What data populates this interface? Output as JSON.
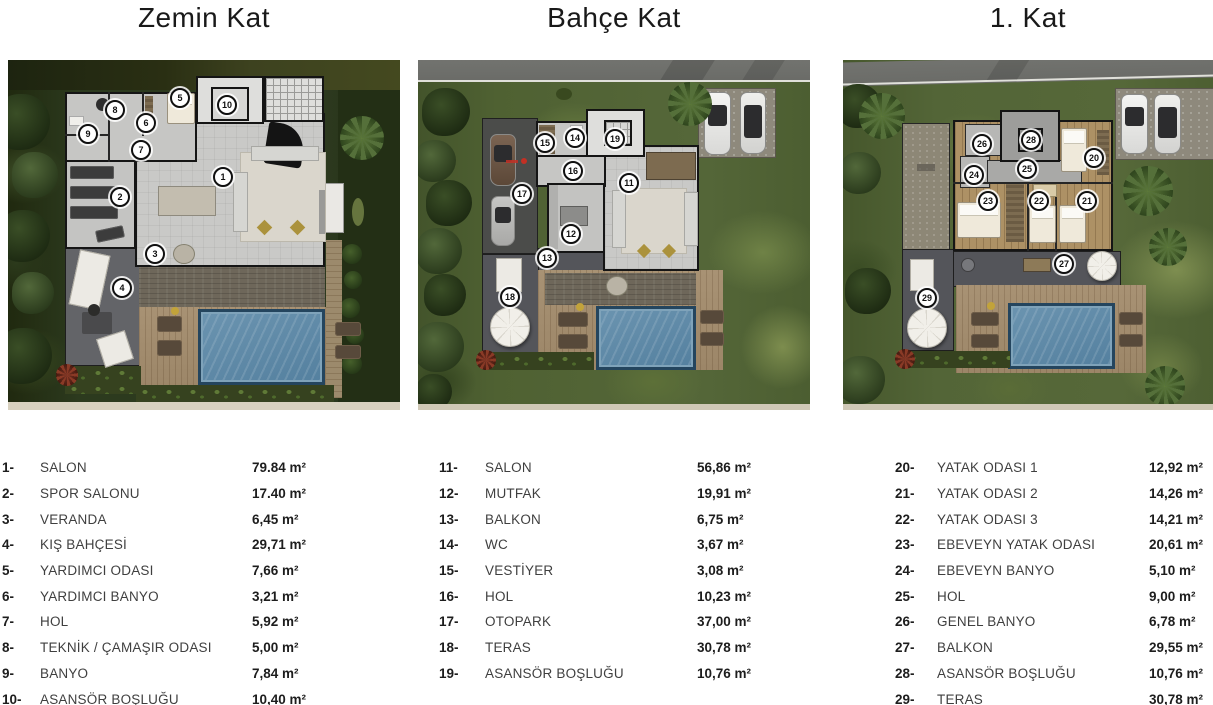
{
  "page": {
    "background": "#ffffff"
  },
  "palette": {
    "pool_blue": "#5d89a7",
    "garden_dark_green": "#2e3b20",
    "garden_light_green": "#556739",
    "deck_wood": "#a38a67",
    "terrace_gray": "#5b5c60",
    "house_floor_gray": "#c9c9c7",
    "wall_black": "#151515",
    "badge_background": "#ffffff",
    "text_dark": "#1d1d1d"
  },
  "floors": [
    {
      "title": "Zemin Kat",
      "rooms": [
        {
          "num": "1",
          "label": "SALON",
          "area": "79.84 m²"
        },
        {
          "num": "2",
          "label": "SPOR SALONU",
          "area": "17.40 m²"
        },
        {
          "num": "3",
          "label": "VERANDA",
          "area": "6,45 m²"
        },
        {
          "num": "4",
          "label": "KIŞ BAHÇESİ",
          "area": "29,71 m²"
        },
        {
          "num": "5",
          "label": "YARDIMCI ODASI",
          "area": "7,66 m²"
        },
        {
          "num": "6",
          "label": "YARDIMCI BANYO",
          "area": "3,21 m²"
        },
        {
          "num": "7",
          "label": "HOL",
          "area": "5,92 m²"
        },
        {
          "num": "8",
          "label": "TEKNİK / ÇAMAŞIR ODASI",
          "area": "5,00 m²"
        },
        {
          "num": "9",
          "label": "BANYO",
          "area": "7,84 m²"
        },
        {
          "num": "10",
          "label": "ASANSÖR BOŞLUĞU",
          "area": "10,40 m²"
        }
      ]
    },
    {
      "title": "Bahçe Kat",
      "rooms": [
        {
          "num": "11",
          "label": "SALON",
          "area": "56,86 m²"
        },
        {
          "num": "12",
          "label": "MUTFAK",
          "area": "19,91 m²"
        },
        {
          "num": "13",
          "label": "BALKON",
          "area": "6,75 m²"
        },
        {
          "num": "14",
          "label": "WC",
          "area": "3,67 m²"
        },
        {
          "num": "15",
          "label": "VESTİYER",
          "area": "3,08 m²"
        },
        {
          "num": "16",
          "label": "HOL",
          "area": "10,23 m²"
        },
        {
          "num": "17",
          "label": "OTOPARK",
          "area": "37,00 m²"
        },
        {
          "num": "18",
          "label": "TERAS",
          "area": "30,78 m²"
        },
        {
          "num": "19",
          "label": "ASANSÖR BOŞLUĞU",
          "area": "10,76 m²"
        }
      ]
    },
    {
      "title": "1. Kat",
      "rooms": [
        {
          "num": "20",
          "label": "YATAK ODASI 1",
          "area": "12,92 m²"
        },
        {
          "num": "21",
          "label": "YATAK ODASI 2",
          "area": "14,26 m²"
        },
        {
          "num": "22",
          "label": "YATAK ODASI 3",
          "area": "14,21 m²"
        },
        {
          "num": "23",
          "label": "EBEVEYN YATAK ODASI",
          "area": "20,61 m²"
        },
        {
          "num": "24",
          "label": "EBEVEYN BANYO",
          "area": "5,10 m²"
        },
        {
          "num": "25",
          "label": "HOL",
          "area": "9,00 m²"
        },
        {
          "num": "26",
          "label": "GENEL BANYO",
          "area": "6,78 m²"
        },
        {
          "num": "27",
          "label": "BALKON",
          "area": "29,55 m²"
        },
        {
          "num": "28",
          "label": "ASANSÖR BOŞLUĞU",
          "area": "10,76 m²"
        },
        {
          "num": "29",
          "label": "TERAS",
          "area": "30,78 m²"
        }
      ]
    }
  ]
}
